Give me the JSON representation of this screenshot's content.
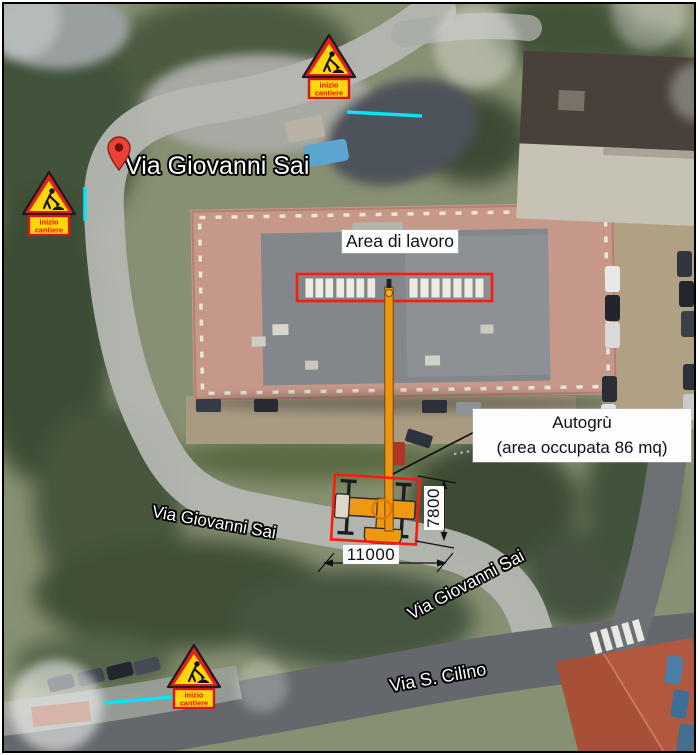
{
  "street_labels": {
    "main": "Via Giovanni Sai",
    "west": "Via Giovanni Sai",
    "south": "Via Giovanni Sai",
    "cilino": "Via S. Cilino"
  },
  "annotations": {
    "work_area": "Area di lavoro",
    "crane_line1": "Autogrù",
    "crane_line2": "(area occupata 86 mq)"
  },
  "dimensions": {
    "width": "11000",
    "depth": "7800"
  },
  "sign": {
    "line1": "inizio",
    "line2": "cantiere"
  },
  "colors": {
    "annotation_red": "#ff1a0e",
    "crane_orange": "#ef9410",
    "cyan_marker": "#0ae2f5",
    "sign_red": "#e32119",
    "sign_yellow": "#ffd60a",
    "pin_red": "#ea4335"
  }
}
